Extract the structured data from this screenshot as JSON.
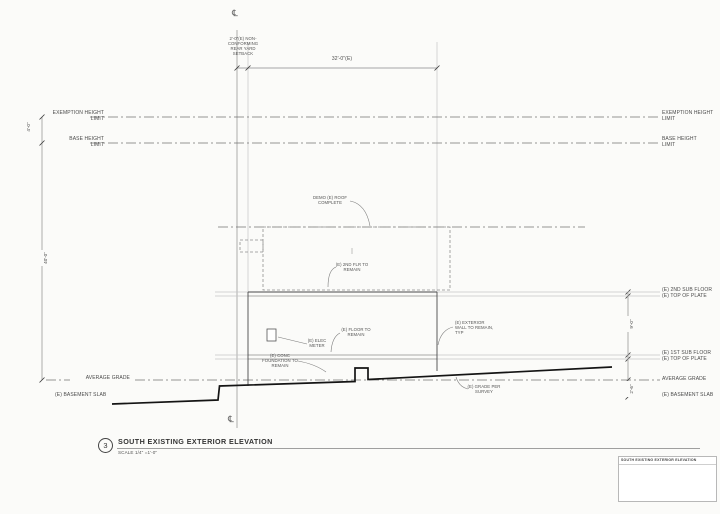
{
  "sheet": {
    "number": "3",
    "title": "SOUTH EXISTING EXTERIOR ELEVATION",
    "scale": "SCALE 1/4\" =1'-0\""
  },
  "property_line": {
    "symbol": "℄"
  },
  "dimensions": {
    "setback_lines": [
      "2'-0\"(E) NON-",
      "CONFORMING",
      "REAR YARD",
      "SETBACK"
    ],
    "building_width": "32'-0\"(E)",
    "exemption_gap": "4'-0\"",
    "height_limit": "40'-0\"",
    "floor_height": "9'-0\"",
    "slab_depth": "2'-6\""
  },
  "levels_left": {
    "exemption": [
      "EXEMPTION HEIGHT",
      "LIMIT"
    ],
    "base": [
      "BASE HEIGHT",
      "LIMIT"
    ],
    "average_grade": "AVERAGE GRADE",
    "basement_slab": "(E) BASEMENT SLAB"
  },
  "levels_right": {
    "exemption": [
      "EXEMPTION HEIGHT",
      "LIMIT"
    ],
    "base": [
      "BASE HEIGHT",
      "LIMIT"
    ],
    "floor2": [
      "(E) 2ND SUB FLOOR",
      "(E) TOP OF PLATE"
    ],
    "floor1": [
      "(E) 1ST SUB FLOOR",
      "(E) TOP OF PLATE"
    ],
    "average_grade": "AVERAGE GRADE",
    "basement_slab": "(E) BASEMENT SLAB"
  },
  "annotations": {
    "demo_roof": [
      "DEMO (E) ROOF",
      "COMPLETE"
    ],
    "second_floor": [
      "(E) 2ND FLR TO",
      "REMAIN"
    ],
    "floor_remain": [
      "(E) FLOOR TO",
      "REMAIN"
    ],
    "elec_meter": [
      "(E) ELEC",
      "METER"
    ],
    "foundation": [
      "(E) CONC",
      "FOUNDATION TO",
      "REMAIN"
    ],
    "exterior_wall": [
      "(E) EXTERIOR",
      "WALL TO REMAIN,",
      "TYP"
    ],
    "grade_survey": [
      "(E) GRADE PER",
      "SURVEY"
    ]
  },
  "title_block": {
    "header": "SOUTH EXISTING EXTERIOR ELEVATION"
  }
}
